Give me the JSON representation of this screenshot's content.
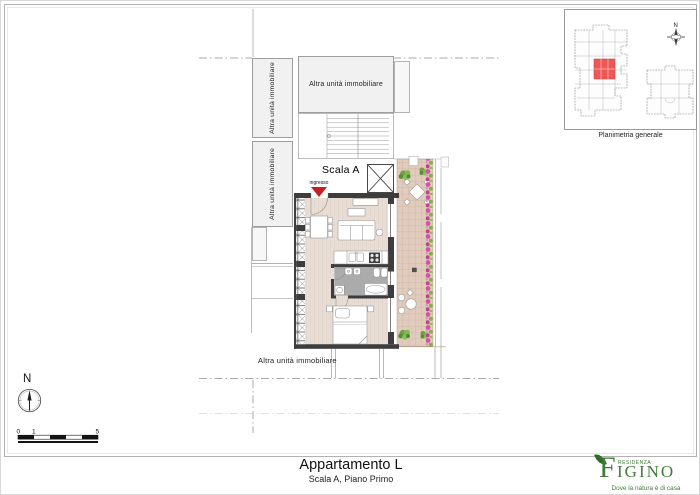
{
  "plan": {
    "other_unit_label": "Altra unità immobiliare",
    "stair_label": "Scala A",
    "entrance_label": "ingresso"
  },
  "minimap": {
    "caption": "Planimetria generale",
    "north": "N",
    "highlight_color": "#ef5656"
  },
  "north_arrow": {
    "label": "N"
  },
  "scale_bar": {
    "tick0": "0",
    "tick1": "1",
    "tick5": "5"
  },
  "footer": {
    "title": "Appartamento L",
    "subtitle": "Scala A, Piano Primo"
  },
  "logo": {
    "residenza": "RESIDENZA",
    "initial": "F",
    "rest": "IGINO",
    "tagline": "Dove la natura è di casa",
    "green": "#3e7d35"
  },
  "colors": {
    "wall": "#3d3d3d",
    "entrance_marker": "#c42020",
    "terrace_tile": "#e0cbbc",
    "wood_floor": "#eadfd8",
    "bath_floor": "#ababab",
    "neighbor_fill": "#f1f1f1",
    "plant_green": "#6aa445",
    "flower_pink": "#d0569f"
  }
}
